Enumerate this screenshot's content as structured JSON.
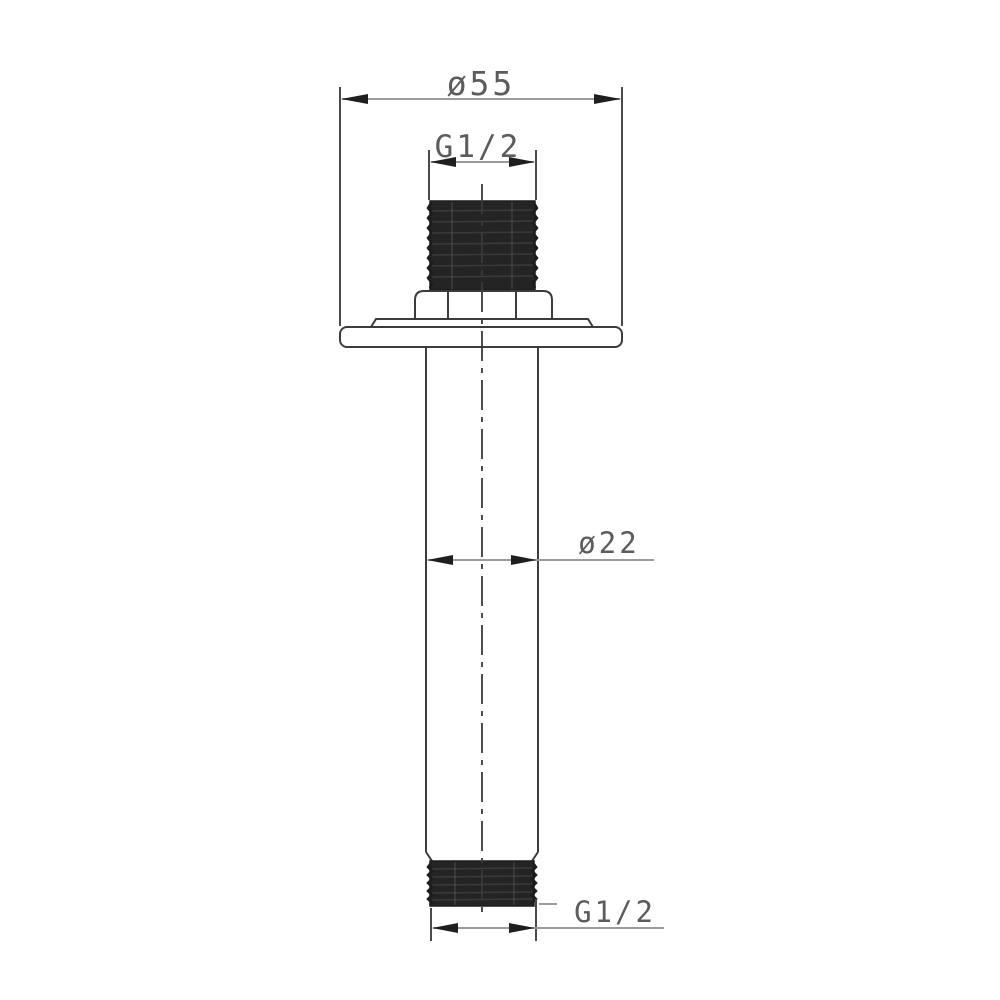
{
  "drawing": {
    "labels": {
      "flange_diameter": "ø55",
      "top_thread_size": "G1/2",
      "arm_diameter": "ø22",
      "bottom_thread_size": "G1/2"
    },
    "colors": {
      "background": "#ffffff",
      "outline": "#3c3c3c",
      "dimension_line": "#9b9b9b",
      "extension_line": "#4a4a4a",
      "arrowhead": "#1f1f1f",
      "thread_fill": "#242424",
      "label_text": "#5c5c5c"
    }
  }
}
